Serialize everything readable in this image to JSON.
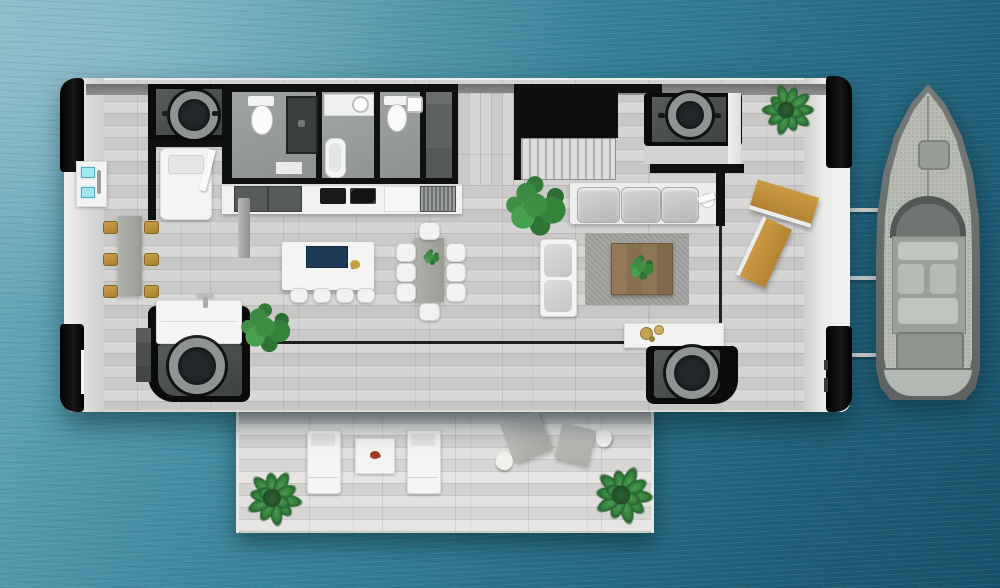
{
  "meta": {
    "description": "Top-down 3D architectural floor plan of a floating house (houseboat) surrounded by turquoise sea, with a motor yacht moored along the right side and an aft sun terrace at the bottom.",
    "visible_text": []
  },
  "palette": {
    "water_light": "#7fb2c3",
    "water_dark": "#17506a",
    "deck_plank": "#c8c7c5",
    "walkway_white": "#ececea",
    "wall_black": "#101010",
    "bathroom_floor": "#979c9c",
    "pod_ring_gray": "#8f9392",
    "sofa_white": "#eceeec",
    "cushion_gray": "#c4c7c5",
    "lounger_gold": "#c2913a",
    "stool_gold": "#b98c3c",
    "rug_gray": "#a0a09c",
    "coffee_table_wood": "#8b7052",
    "island_sink_navy": "#1d3a55",
    "plant_green": "#3e8f44",
    "boat_hull": "#686c6a",
    "boat_deck": "#b7bbb3",
    "screen_cyan": "#9fe8ef"
  },
  "labels": {
    "scene": "floating-house-floor-plan",
    "water": "sea water",
    "boat": "moored motor yacht, bow up",
    "mooring_lines": "three mooring lines to yacht",
    "main_platform": "main deck platform with black corner pontoons",
    "aft_terrace": "lower sun terrace deck",
    "bathrooms": "bathroom block with two WCs, shower, bathtub and closet",
    "kitchen": "kitchen counter row with sink, cooktop and cabinets",
    "island": "kitchen island with navy sink, fruit bowl and four stools",
    "dining": "dining table with eight white chairs",
    "living": "living room with three-seat sofa, chaise, rug and wood coffee table",
    "stairs": "staircase with black landing",
    "pods": "four round-hatch machinery pods in corners",
    "bar": "side bar table with six gold stools",
    "daybed": "white daybed in front-left cabin",
    "vanity": "white vanity sink unit",
    "console": "white console shelf with gold bowls",
    "loungers": "two gold sun loungers on right deck",
    "control_panel": "wall unit with two cyan displays",
    "palms": "three potted palm trees",
    "terrace_furniture": "two white loungers, side table, two gray seats, two cushions"
  },
  "inventory": {
    "rooms": [
      "bathroom-left",
      "bathroom-middle-with-tub",
      "bathroom-right",
      "closet",
      "kitchen",
      "stair-hall",
      "living-room",
      "dining-area",
      "front-cabin"
    ],
    "corner_pods": 4,
    "palm_trees": 3,
    "indoor_plants": 4,
    "dining_chairs": 8,
    "bar_stools_gold": 6,
    "island_stools_white": 4,
    "sofa_seats": 3,
    "gold_sun_loungers": 2,
    "terrace_loungers_white": 2,
    "mooring_lines": 3
  }
}
